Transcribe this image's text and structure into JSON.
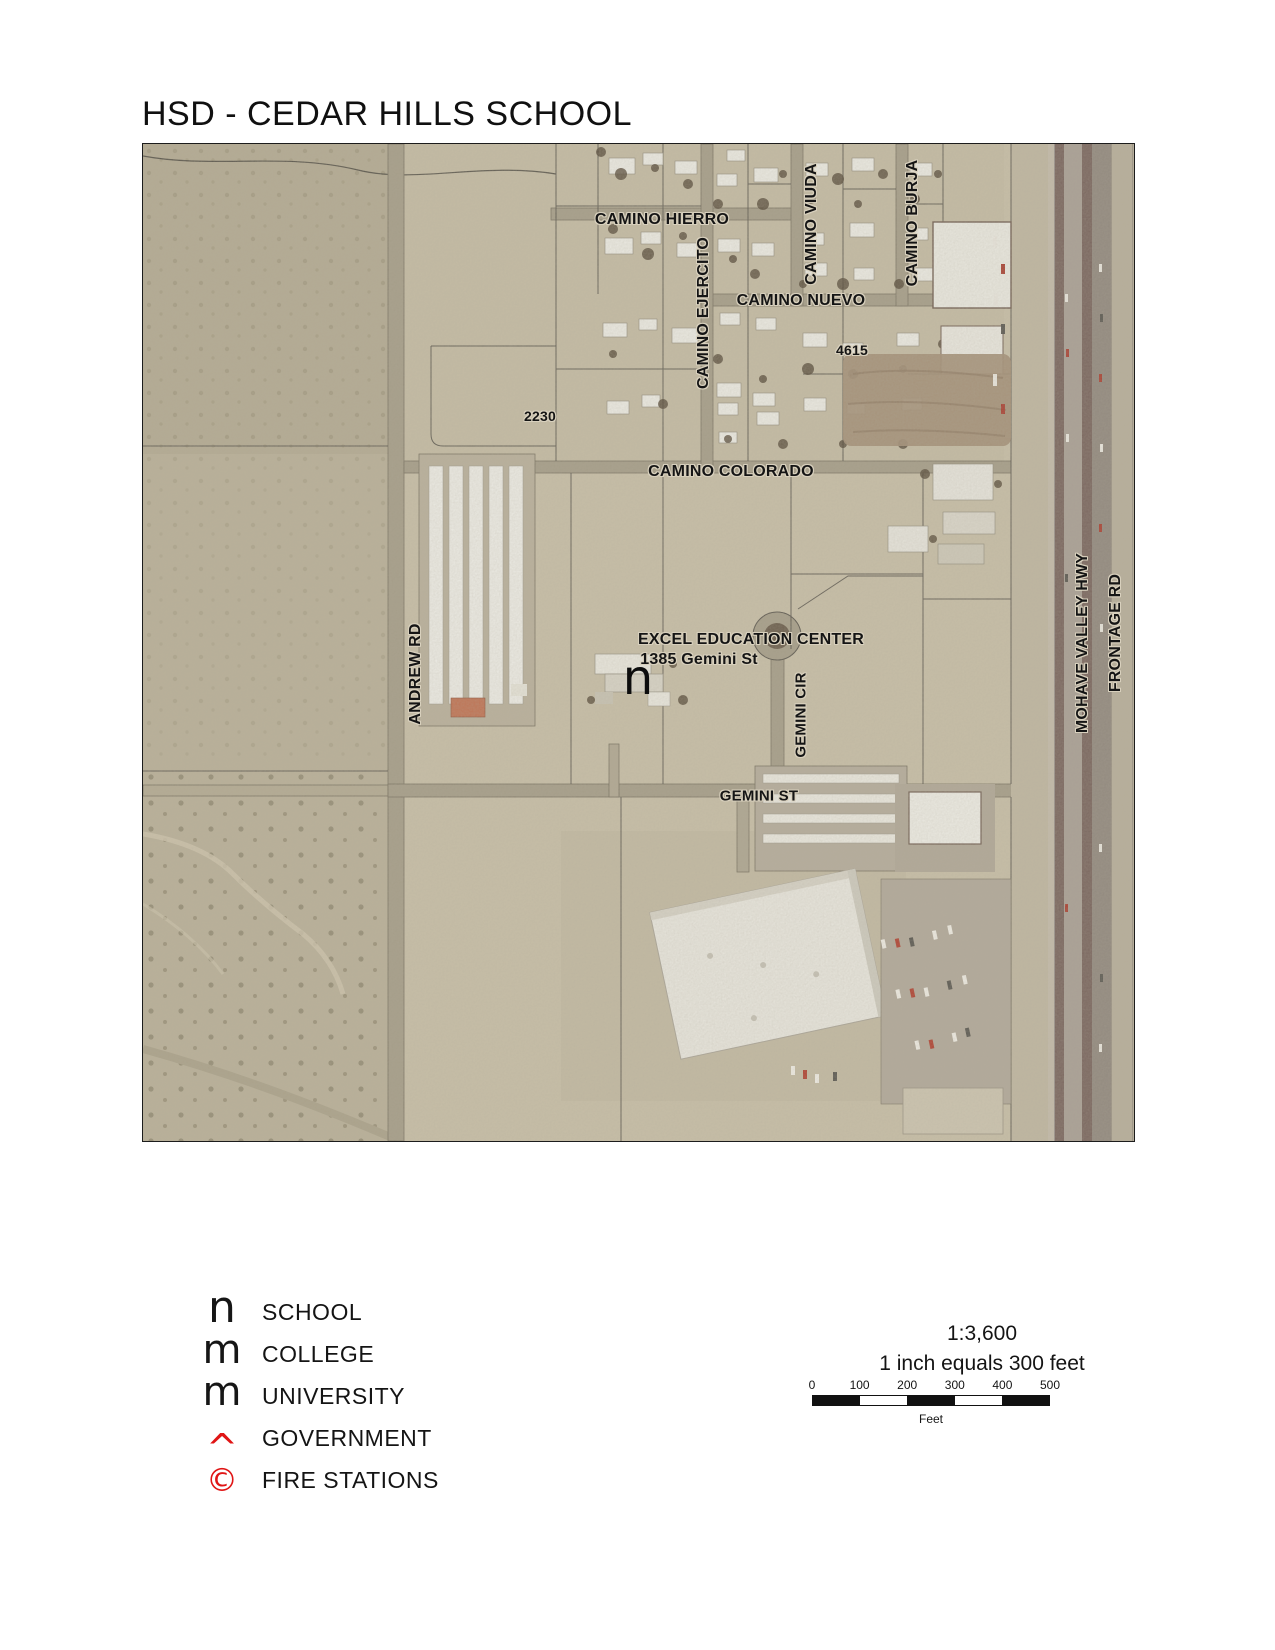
{
  "title": "HSD - CEDAR HILLS SCHOOL",
  "map": {
    "labels": [
      {
        "text": "CAMINO HIERRO",
        "x": 519,
        "y": 76,
        "rot": 0,
        "size": 16
      },
      {
        "text": "CAMINO EJERCITO",
        "x": 561,
        "y": 169,
        "rot": -90,
        "size": 16
      },
      {
        "text": "CAMINO VIUDA",
        "x": 669,
        "y": 80,
        "rot": -90,
        "size": 16
      },
      {
        "text": "CAMINO BURJA",
        "x": 770,
        "y": 79,
        "rot": -90,
        "size": 16
      },
      {
        "text": "CAMINO NUEVO",
        "x": 658,
        "y": 157,
        "rot": 0,
        "size": 16
      },
      {
        "text": "4615",
        "x": 709,
        "y": 206,
        "rot": 0,
        "size": 14
      },
      {
        "text": "2230",
        "x": 397,
        "y": 272,
        "rot": 0,
        "size": 14
      },
      {
        "text": "CAMINO COLORADO",
        "x": 588,
        "y": 328,
        "rot": 0,
        "size": 16
      },
      {
        "text": "ANDREW RD",
        "x": 273,
        "y": 530,
        "rot": -90,
        "size": 16
      },
      {
        "text": "EXCEL EDUCATION CENTER",
        "x": 608,
        "y": 496,
        "rot": 0,
        "size": 16
      },
      {
        "text": "1385 Gemini St",
        "x": 556,
        "y": 516,
        "rot": 0,
        "size": 16
      },
      {
        "text": "GEMINI CIR",
        "x": 658,
        "y": 571,
        "rot": -90,
        "size": 15
      },
      {
        "text": "GEMINI ST",
        "x": 616,
        "y": 652,
        "rot": 0,
        "size": 15
      },
      {
        "text": "MOHAVE VALLEY HWY",
        "x": 940,
        "y": 499,
        "rot": -90,
        "size": 16
      },
      {
        "text": "FRONTAGE RD",
        "x": 973,
        "y": 489,
        "rot": -90,
        "size": 16
      }
    ],
    "school_symbol": {
      "glyph": "n"
    }
  },
  "legend": {
    "items": [
      {
        "symbol": "n",
        "label": "SCHOOL",
        "color": "#161616"
      },
      {
        "symbol": "m",
        "label": "COLLEGE",
        "color": "#161616"
      },
      {
        "symbol": "m",
        "label": "UNIVERSITY",
        "color": "#161616"
      },
      {
        "symbol": "^",
        "label": "GOVERNMENT",
        "color": "#e01515"
      },
      {
        "symbol": "©",
        "label": "FIRE STATIONS",
        "color": "#e01515"
      }
    ]
  },
  "scalebar": {
    "ratio": "1:3,600",
    "equiv": "1 inch equals 300 feet",
    "ticks": [
      "0",
      "100",
      "200",
      "300",
      "400",
      "500"
    ],
    "unit": "Feet",
    "bar_colors": [
      "#111111",
      "#ffffff",
      "#111111",
      "#ffffff",
      "#111111"
    ]
  }
}
